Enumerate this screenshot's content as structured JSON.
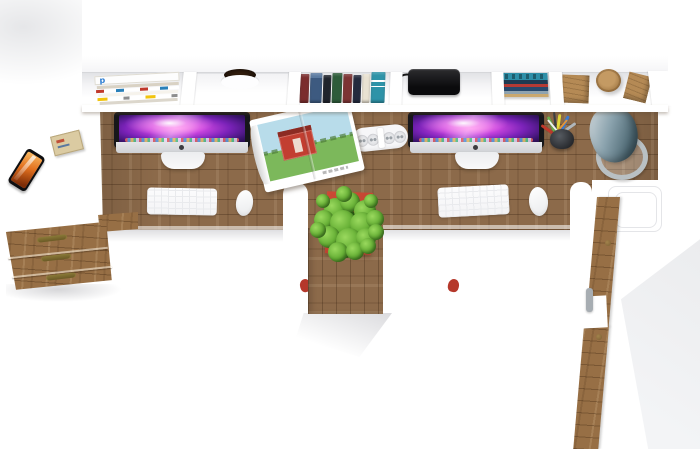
{
  "scene": {
    "type": "3d-render-top-view",
    "subject": "double office workstation with hutch, drawers and cabinet",
    "text_visible": "none"
  },
  "colors": {
    "floor": "#ffffff",
    "hutch": "#ffffff",
    "interior-shade": "#e7e8ea",
    "wood": "#8c6a4a",
    "wood-r": "#976f45",
    "wood-block": "#b58a55",
    "screen-dark": "#1e0a3c",
    "screen-magenta": "#c945de",
    "screen-pink": "#ff7ae8",
    "chin": "#cfd1d5",
    "pot": "#b7402f",
    "plant-light": "#9ad95e",
    "plant-mid": "#63ad33",
    "plant-dark": "#35701a",
    "lamp-light": "#cdd6da",
    "lamp-dark": "#3a525c",
    "lamp-ring": "#b9c0c3",
    "sky": "#b8dcea",
    "grass": "#7cb85b",
    "barn": "#c23e31",
    "phone-screen": "#e2701e",
    "brass": "#6b5a26",
    "knob": "#7a5e33",
    "shadow": "#ebecee",
    "book-spines": [
      "#7b2d2d",
      "#3d5a80",
      "#20242c",
      "#2e5c3a",
      "#7d3434",
      "#242b3e",
      "#e9e2d2",
      "#2e93a8"
    ],
    "flat-stack": [
      "#2e8fa8",
      "#1d3a52",
      "#b33a35",
      "#27496d",
      "#8fa3b0",
      "#caa86f"
    ]
  },
  "objects": [
    "wall-hutch-shelf",
    "magazine-stack",
    "shelf-drawer-finger-pull",
    "book-row",
    "black-gadget",
    "flat-book-stack",
    "wood-cube",
    "wood-cylinder",
    "wood-wedge",
    "desk-top-left",
    "desk-top-right",
    "desk-return-white",
    "pedestal-column",
    "imac-left",
    "imac-right",
    "apple-keyboard-left",
    "apple-keyboard-right",
    "apple-mouse-left",
    "apple-mouse-right",
    "open-magazine-barn-photo",
    "power-strip",
    "pencil-cup",
    "desk-lamp-cone",
    "potted-plant",
    "smartphone",
    "matchbox",
    "three-drawer-unit",
    "tall-side-cabinet",
    "red-chair-fragments"
  ]
}
